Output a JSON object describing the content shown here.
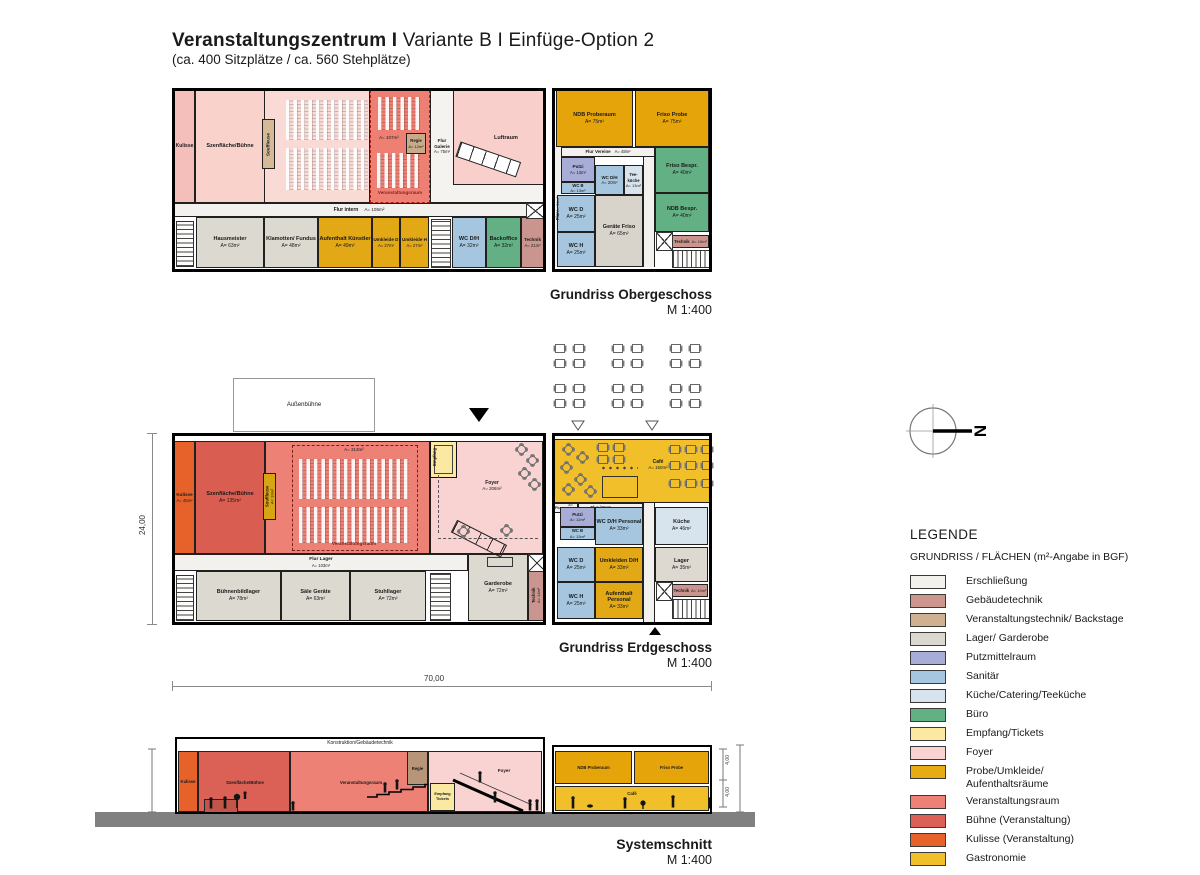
{
  "title": {
    "bold": "Veranstaltungszentrum I",
    "regular": " Variante B I  Einfüge-Option 2",
    "subtitle": "(ca. 400 Sitzplätze / ca. 560 Stehplätze)"
  },
  "og": {
    "caption": "Grundriss Obergeschoss",
    "scale": "M 1:400",
    "rooms": {
      "kulisse": {
        "label": "Kulisse"
      },
      "szene": {
        "label": "Szenfläche/Bühne"
      },
      "souffleuse": {
        "label": "Souffleuse"
      },
      "vraum": {
        "area": "A= 107m²",
        "label": "Veranstaltungsraum"
      },
      "regie": {
        "label": "Regie",
        "area": "A= 12m²"
      },
      "flurgalerie": {
        "label": "Flur Galerie",
        "area": "A= 75m²"
      },
      "luftraum": {
        "label": "Luftraum"
      },
      "flurintern": {
        "label": "Flur intern",
        "area": "A= 105m²"
      },
      "flur": {
        "label": "Flur",
        "area": "A= 34m²"
      },
      "hausmeister": {
        "label": "Hausmeister",
        "area": "A= 63m²"
      },
      "klamotten": {
        "label": "Klamotten/ Fundus",
        "area": "A= 48m²"
      },
      "aufenthalt": {
        "label": "Aufenthalt Künstler",
        "area": "A= 49m²"
      },
      "umkleide_d": {
        "label": "Umkleide D",
        "area": "A= 27m²"
      },
      "umkleide_h": {
        "label": "Umkleide H",
        "area": "A= 27m²"
      },
      "wc_dh": {
        "label": "WC D/H",
        "area": "A= 32m²"
      },
      "backoffice": {
        "label": "Backoffice",
        "area": "A= 32m²"
      },
      "technik": {
        "label": "Technik",
        "area": "A= 21m²"
      },
      "ndb_proberaum": {
        "label": "NDB Proberaum",
        "area": "A= 75m²"
      },
      "friso_probe": {
        "label": "Friso Probe",
        "area": "A= 75m²"
      },
      "flur_vereine": {
        "label": "Flur Vereine",
        "area": "A= 48m²"
      },
      "putzi": {
        "label": "Putzi",
        "area": "A= 13m²"
      },
      "wc_b": {
        "label": "WC B",
        "area": "A= 13m²"
      },
      "wc_dh2": {
        "label": "WC D/H",
        "area": "A= 20m²"
      },
      "teekueche": {
        "label": "Tee- küche",
        "area": "A= 13m²"
      },
      "friso_bespr": {
        "label": "Friso Bespr.",
        "area": "A= 40m²"
      },
      "wc_d": {
        "label": "WC D",
        "area": "A= 25m²"
      },
      "geraete_friso": {
        "label": "Geräte Friso",
        "area": "A= 65m²"
      },
      "ndb_bespr": {
        "label": "NDB Bespr.",
        "area": "A= 40m²"
      },
      "wc_h": {
        "label": "WC H",
        "area": "A= 25m²"
      },
      "technik2": {
        "label": "Technik",
        "area": "A= 10m²"
      }
    }
  },
  "eg": {
    "caption": "Grundriss Erdgeschoss",
    "scale": "M 1:400",
    "aussenbuehne": "Außenbühne",
    "rooms": {
      "kulisse": {
        "label": "Kulisse",
        "area": "A= 45m²"
      },
      "szene": {
        "label": "Szenfläche/Bühne",
        "area": "A= 135m²"
      },
      "souffleuse": {
        "label": "Souffleuse",
        "area": "A= 10m²"
      },
      "vraum": {
        "area": "A= 313m²",
        "label": "Veranstaltungsraum"
      },
      "empfang": {
        "label": "Empfang"
      },
      "foyer": {
        "label": "Foyer",
        "area": "A= 208m²"
      },
      "flur_lager": {
        "label": "Flur Lager",
        "area": "A= 103m²"
      },
      "buehnenbildlager": {
        "label": "Bühnenbildlager",
        "area": "A= 78m²"
      },
      "saele_geraete": {
        "label": "Säle Geräte",
        "area": "A= 63m²"
      },
      "stuhllager": {
        "label": "Stuhllager",
        "area": "A= 72m²"
      },
      "garderobe": {
        "label": "Garderobe",
        "area": "A= 72m²"
      },
      "technik": {
        "label": "Technik",
        "area": "A= 14m²"
      },
      "cafe": {
        "label": "Café",
        "area": "A= 150m²"
      },
      "flur": {
        "label": "Flur",
        "area": "A= 40m²"
      },
      "flurintern": {
        "label": "Flur intern",
        "area": "A= 40m²"
      },
      "putzi": {
        "label": "Putzi",
        "area": "A= 12m²"
      },
      "wc_b": {
        "label": "WC B",
        "area": "A= 13m²"
      },
      "wc_dh_personal": {
        "label": "WC D/H Personal",
        "area": "A= 33m²"
      },
      "kueche": {
        "label": "Küche",
        "area": "A= 46m²"
      },
      "wc_d": {
        "label": "WC D",
        "area": "A= 25m²"
      },
      "umkleiden": {
        "label": "Umkleiden D/H",
        "area": "A= 33m²"
      },
      "lager": {
        "label": "Lager",
        "area": "A= 35m²"
      },
      "wc_h": {
        "label": "WC H",
        "area": "A= 25m²"
      },
      "aufenthalt_personal": {
        "label": "Aufenthalt Personal",
        "area": "A= 33m²"
      },
      "technik2": {
        "label": "Technik",
        "area": "A= 10m²"
      }
    }
  },
  "schnitt": {
    "caption": "Systemschnitt",
    "scale": "M 1:400",
    "labels": {
      "konstruktion": "Konstruktion/Gebäudetechnik",
      "kulisse": "Kulisse",
      "szene": "Szenfläche/Bühne",
      "vraum": "Veranstaltungsraum",
      "regie": "Regie",
      "empfang": "Empfang Tickets",
      "foyer": "Foyer",
      "ndb": "NDB Proberaum",
      "friso": "Friso Probe",
      "cafe": "Café"
    },
    "dims": [
      "4,00",
      "4,00"
    ]
  },
  "dims": {
    "width": "70,00",
    "height": "24,00"
  },
  "north": {
    "label": "N"
  },
  "legend": {
    "title": "LEGENDE",
    "subtitle": "GRUNDRISS / FLÄCHEN (m²-Angabe in BGF)",
    "items": [
      {
        "label": "Erschließung",
        "color": "#f2f1ed"
      },
      {
        "label": "Gebäudetechnik",
        "color": "#cc968f"
      },
      {
        "label": "Veranstaltungstechnik/ Backstage",
        "color": "#cfb091"
      },
      {
        "label": "Lager/ Garderobe",
        "color": "#dbd8d0"
      },
      {
        "label": "Putzmittelraum",
        "color": "#a8add7"
      },
      {
        "label": "Sanitär",
        "color": "#a5c6de"
      },
      {
        "label": "Küche/Catering/Teeküche",
        "color": "#d7e4ee"
      },
      {
        "label": "Büro",
        "color": "#62b083"
      },
      {
        "label": "Empfang/Tickets",
        "color": "#fbe9a2"
      },
      {
        "label": "Foyer",
        "color": "#f8d3d2"
      },
      {
        "label": "Probe/Umkleide/ Aufenthaltsräume",
        "color": "#e7ac14"
      },
      {
        "label": "Veranstaltungsraum",
        "color": "#ee8176"
      },
      {
        "label": "Bühne (Veranstaltung)",
        "color": "#db6156"
      },
      {
        "label": "Kulisse (Veranstaltung)",
        "color": "#e7622b"
      },
      {
        "label": "Gastronomie",
        "color": "#f1bf29"
      }
    ]
  }
}
